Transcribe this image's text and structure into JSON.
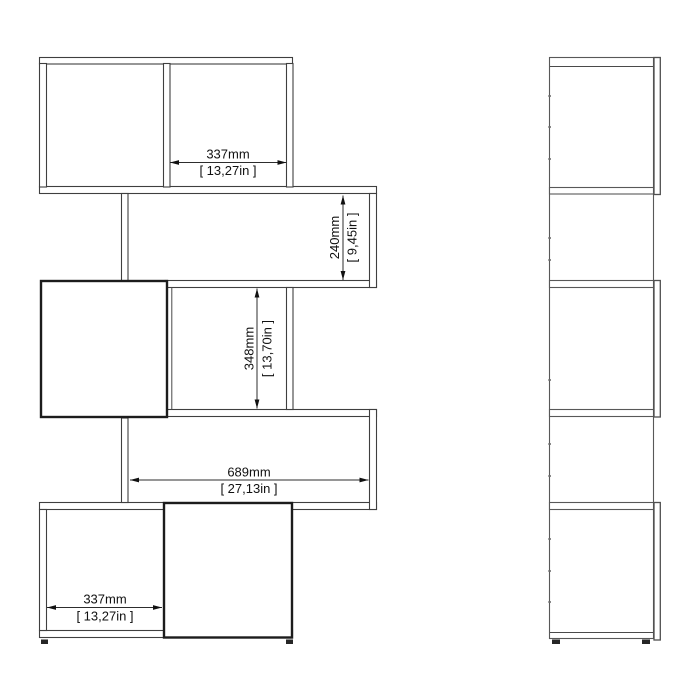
{
  "drawing": {
    "background_color": "#ffffff",
    "line_color": "#3f3f3f",
    "views": {
      "front": "front-elevation-view",
      "side": "side-elevation-view"
    },
    "dimensions": {
      "top_compartment_width": {
        "mm": "337mm",
        "inches": "[ 13,27in ]"
      },
      "upper_opening_height": {
        "mm": "240mm",
        "inches": "[ 9,45in ]"
      },
      "middle_opening_height": {
        "mm": "348mm",
        "inches": "[ 13,70in ]"
      },
      "lower_opening_width": {
        "mm": "689mm",
        "inches": "[ 27,13in ]"
      },
      "bottom_compartment_width": {
        "mm": "337mm",
        "inches": "[ 13,27in ]"
      }
    }
  }
}
